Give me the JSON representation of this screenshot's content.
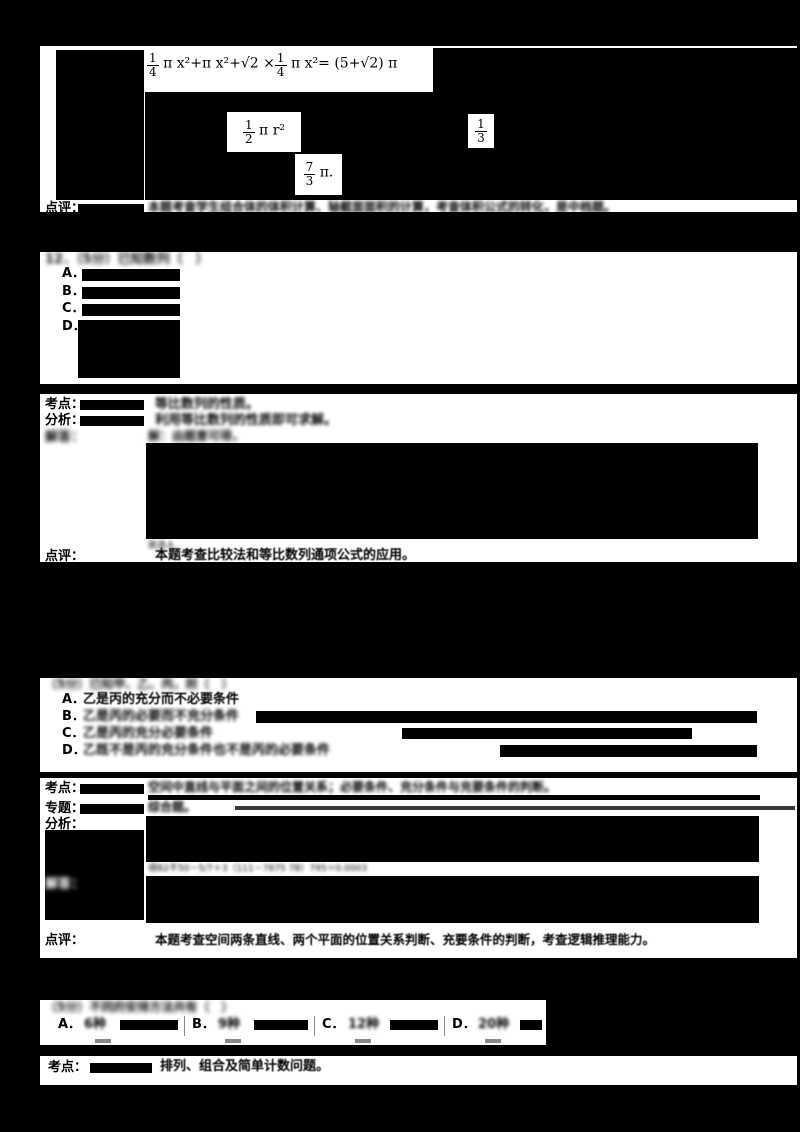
{
  "colors": {
    "page_bg": "#000000",
    "paper": "#ffffff",
    "ink": "#000000"
  },
  "sec_volume": {
    "formula": {
      "frac_a_num": "1",
      "frac_a_den": "4",
      "mid": " π x²+π x²+√2 ×",
      "frac_b_num": "1",
      "frac_b_den": "4",
      "tail": " π x²= (5+√2) π"
    },
    "patch_half": {
      "num": "1",
      "den": "2",
      "rest": " π  r²"
    },
    "patch_third": {
      "num": "1",
      "den": "3"
    },
    "patch_seven_thirds": {
      "num": "7",
      "den": "3",
      "rest": " π."
    },
    "comment": {
      "label": "点评：",
      "text": "本题考查学生组合体的体积计算、轴截面面积的计算，考查体积公式的转化，是中档题。"
    }
  },
  "q12": {
    "header": "12．（5分）已知数列（　）",
    "opt_a": "A．",
    "opt_b": "B．",
    "opt_c": "C．",
    "opt_d": "D．"
  },
  "sol12": {
    "kaodian": {
      "label": "考点：",
      "text": "等比数列的性质。"
    },
    "fenxi": {
      "label": "分析：",
      "text": "利用等比数列的性质即可求解。"
    },
    "jieda": {
      "label": "解答：",
      "first_line": "解：由题意可得，"
    },
    "conclusion": "故选Ａ．",
    "dianping": {
      "label": "点评：",
      "text": "本题考查比较法和等比数列通项公式的应用。"
    }
  },
  "q_logic": {
    "header": "（5分）已知甲、乙、丙，则（　）",
    "options": [
      {
        "letter": "A．",
        "text": "乙是丙的充分而不必要条件"
      },
      {
        "letter": "B．",
        "text": "乙是丙的必要而不充分条件"
      },
      {
        "letter": "C．",
        "text": "乙是丙的充分必要条件"
      },
      {
        "letter": "D．",
        "text": "乙既不是丙的充分条件也不是丙的必要条件"
      }
    ]
  },
  "sol_logic": {
    "kaodian": {
      "label": "考点：",
      "text": "空间中直线与平面之间的位置关系；必要条件、充分条件与充要条件的判断。"
    },
    "zhuanti": {
      "label": "专题：",
      "text": "综合题。"
    },
    "fenxi": {
      "label": "分析：",
      "fragment": "得B2不50－5/7＋3（111－7875 7B）795＝0.0003"
    },
    "jieda": {
      "label": "解答："
    },
    "dianping": {
      "label": "点评：",
      "text": "本题考查空间两条直线、两个平面的位置关系判断、充要条件的判断，考查逻辑推理能力。"
    }
  },
  "q_count": {
    "header": "（5分）不同的安排方法共有（　）",
    "options": [
      {
        "letter": "A．",
        "value": "6种"
      },
      {
        "letter": "B．",
        "value": "9种"
      },
      {
        "letter": "C．",
        "value": "12种"
      },
      {
        "letter": "D．",
        "value": "20种"
      }
    ]
  },
  "sol_count": {
    "label": "考点：",
    "text": "排列、组合及简单计数问题。"
  }
}
